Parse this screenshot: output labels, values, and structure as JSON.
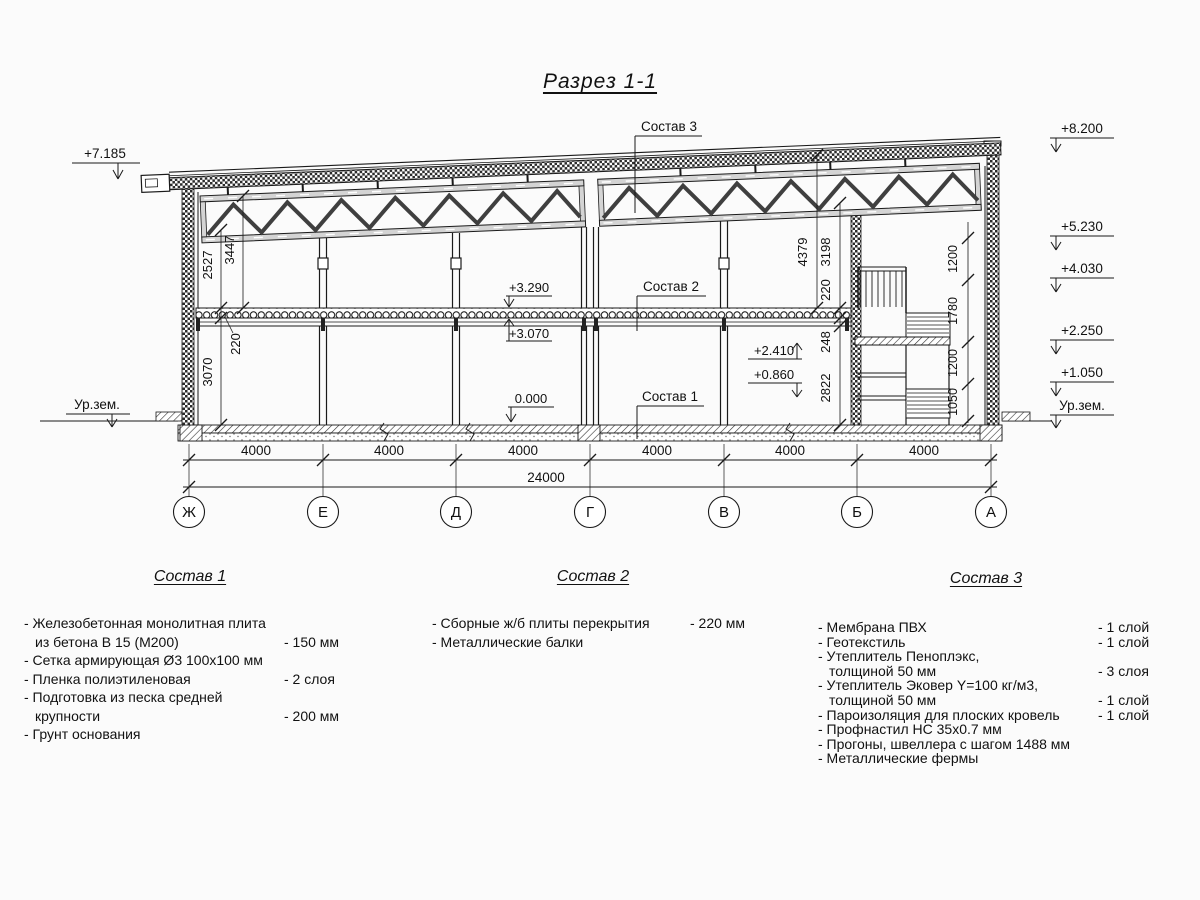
{
  "title": "Разрез 1-1",
  "drawing": {
    "elevation_marks": {
      "left_top": "+7.185",
      "ground_left": "Ур.зем.",
      "right": [
        "+8.200",
        "+5.230",
        "+4.030",
        "+2.250",
        "+1.050",
        "Ур.зем."
      ],
      "interior": {
        "slab_top": "+3.290",
        "slab_soffit": "+3.070",
        "floor": "0.000",
        "landing_upper": "+2.410",
        "landing_lower": "+0.860"
      }
    },
    "layer_leaders": {
      "sostav_3": "Состав 3",
      "sostav_2": "Состав 2",
      "sostav_1": "Состав 1"
    },
    "dimensions": {
      "spans": [
        "4000",
        "4000",
        "4000",
        "4000",
        "4000",
        "4000"
      ],
      "total": "24000",
      "left_interior": {
        "truss_bottom": "2527",
        "truss_top": "3447",
        "slab": "220",
        "floor_height": "3070"
      },
      "right_interior": {
        "roof": "4379",
        "truss": "3198",
        "slab": "220",
        "beam": "248",
        "floor_height": "2822"
      },
      "right_chain": [
        "1200",
        "1780",
        "1200",
        "1050"
      ]
    },
    "axes": [
      "Ж",
      "Е",
      "Д",
      "Г",
      "В",
      "Б",
      "А"
    ]
  },
  "legend": {
    "sostav1": {
      "title": "Состав 1",
      "items": [
        {
          "line1": "- Железобетонная  монолитная плита",
          "line2": "из бетона В 15 (М200)",
          "value": "- 150 мм"
        },
        {
          "line1": "- Сетка армирующая Ø3 100х100 мм"
        },
        {
          "line1": "- Пленка полиэтиленовая",
          "value": "-  2 слоя"
        },
        {
          "line1": "- Подготовка из песка средней",
          "line2": "крупности",
          "value": "- 200 мм"
        },
        {
          "line1": "- Грунт основания"
        }
      ]
    },
    "sostav2": {
      "title": "Состав 2",
      "items": [
        {
          "line1": "- Сборные ж/б плиты перекрытия",
          "value": "- 220 мм"
        },
        {
          "line1": "- Металлические балки"
        }
      ]
    },
    "sostav3": {
      "title": "Состав 3",
      "items": [
        {
          "line1": "- Мембрана ПВХ",
          "value": "- 1 слой"
        },
        {
          "line1": "- Геотекстиль",
          "value": "- 1 слой"
        },
        {
          "line1": "- Утеплитель Пеноплэкс,",
          "line2": "толщиной 50 мм",
          "value": "- 3 слоя"
        },
        {
          "line1": "- Утеплитель Эковер Y=100 кг/м3,",
          "line2": "толщиной 50 мм",
          "value": "- 1 слой"
        },
        {
          "line1": "- Пароизоляция для плоских кровель",
          "value": "- 1 слой"
        },
        {
          "line1": "- Профнастил НС 35х0.7 мм"
        },
        {
          "line1": "- Прогоны, швеллера с шагом 1488 мм"
        },
        {
          "line1": "- Металлические фермы"
        }
      ]
    }
  }
}
